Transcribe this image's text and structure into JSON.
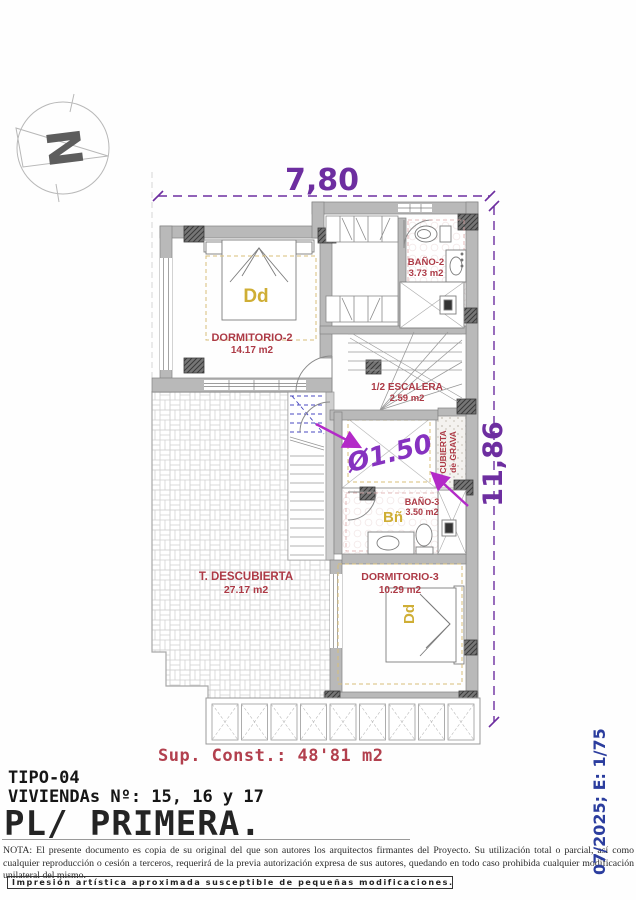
{
  "compass": {
    "letter": "N"
  },
  "dimensions": {
    "top": "7,80",
    "right": "11,86",
    "diameter": "Ø1.50"
  },
  "rooms": {
    "dormitorio2": {
      "name": "DORMITORIO-2",
      "area": "14.17 m2",
      "tag": "Dd"
    },
    "bano2": {
      "name": "BAÑO-2",
      "area": "3.73 m2"
    },
    "escalera": {
      "name": "1/2 ESCALERA",
      "area": "2.59 m2"
    },
    "bano3": {
      "name": "BAÑO-3",
      "area": "3.50 m2",
      "tag": "Bñ"
    },
    "dormitorio3": {
      "name": "DORMITORIO-3",
      "area": "10.29 m2",
      "tag": "Dd"
    },
    "terraza": {
      "name": "T. DESCUBIERTA",
      "area": "27.17 m2"
    },
    "cubierta": {
      "line1": "CUBIERTA",
      "line2": "de GRAVA"
    }
  },
  "titleblock": {
    "sup_const": "Sup. Const.: 48'81 m2",
    "tipo": "TIPO-04",
    "viviendas": "VIVIENDAs Nº: 15, 16 y 17",
    "planta": "PL/ PRIMERA.",
    "nota": "NOTA: El presente documento es copia de su original del que son autores los arquitectos firmantes del Proyecto. Su utilización total o parcial, así como cualquier reproducción o cesión a terceros, requerirá de la previa autorización expresa de sus autores, quedando en todo caso prohibida cualquier modificación unilateral del mismo.",
    "impresion": "Impresión artística aproximada susceptible de pequeñas modificaciones.",
    "edition": "07/2025; E: 1/75"
  },
  "colors": {
    "dimension_purple": "#6d2ea0",
    "arrow_magenta": "#b32ac8",
    "room_label_red": "#ad3a46",
    "tag_yellow": "#cfae35",
    "edition_blue": "#2b3d9e",
    "title_red": "#b2404e",
    "wall_gray": "#b9b9b9"
  }
}
